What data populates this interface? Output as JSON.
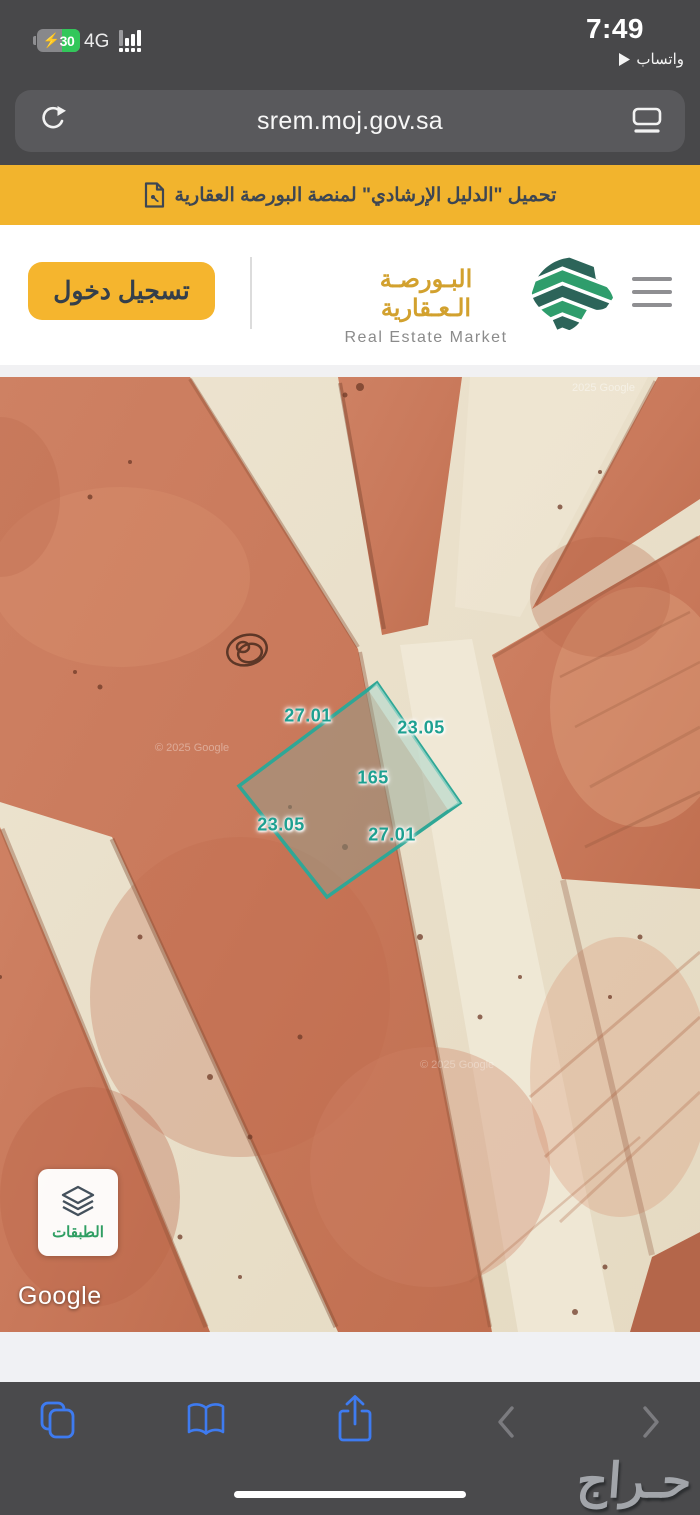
{
  "status_bar": {
    "time": "7:49",
    "battery_percent": "30",
    "network": "4G",
    "return_app_label": "واتساب"
  },
  "url_bar": {
    "url": "srem.moj.gov.sa"
  },
  "banner": {
    "text": "تحميل \"الدليل الإرشادي\" لمنصة البورصة العقارية"
  },
  "header": {
    "login_label": "تسجيل دخول",
    "brand_ar": "البـورصـة الـعـقارية",
    "brand_en": "Real Estate Market"
  },
  "map": {
    "plot": {
      "area": "165",
      "edge_top": "27.01",
      "edge_right": "23.05",
      "edge_left": "23.05",
      "edge_bottom": "27.01"
    },
    "layers_label": "الطبقات",
    "google_logo": "Google",
    "watermarks": [
      "2025 Google",
      "© 2025 Google",
      "© 2025 Google"
    ],
    "colors": {
      "plot_outline": "#2FA796",
      "terrain_orange": "#C9795B",
      "road_beige": "#EAE0CB"
    }
  },
  "toolbar": {
    "icons": [
      "tabs",
      "bookmarks",
      "share",
      "back",
      "forward"
    ]
  },
  "overlay_watermark": "حـراج",
  "colors": {
    "accent_yellow": "#F2B42D",
    "ios_blue": "#3E7BF0",
    "chrome_gray": "#48484A"
  }
}
